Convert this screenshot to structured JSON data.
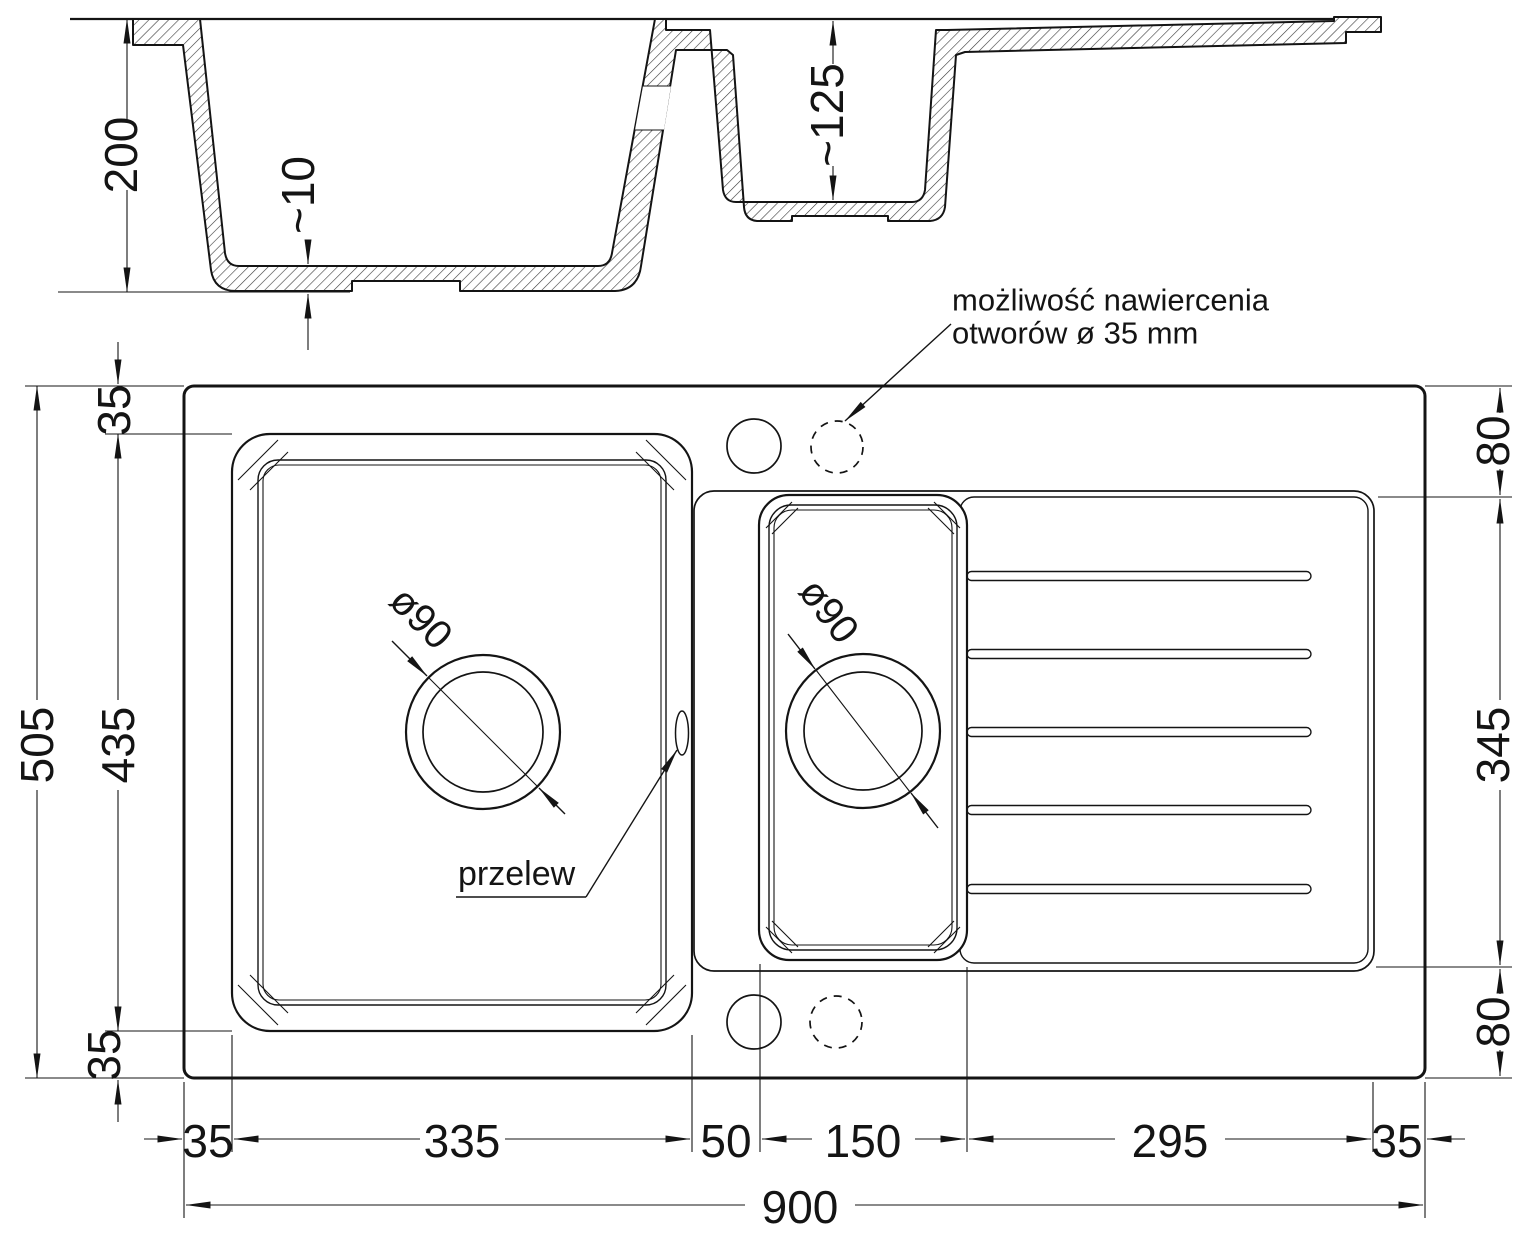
{
  "section": {
    "depth": "200",
    "bottom_thickness": "~10",
    "small_depth": "~125"
  },
  "plan": {
    "left": {
      "top_margin": "35",
      "bowl_height": "435",
      "bottom_margin": "35",
      "total_height": "505"
    },
    "right": {
      "top_offset": "80",
      "drainer_height": "345",
      "bottom_offset": "80"
    },
    "bottom": {
      "left_margin": "35",
      "main_bowl_width": "335",
      "divider": "50",
      "small_bowl_width": "150",
      "drainer_width": "295",
      "right_margin": "35",
      "total_width": "900"
    },
    "main_drain": "ø90",
    "small_drain": "ø90",
    "overflow": "przelew",
    "note1": "możliwość nawiercenia",
    "note2": "otworów ø 35 mm"
  },
  "colors": {
    "line": "#141414",
    "background": "#ffffff"
  }
}
